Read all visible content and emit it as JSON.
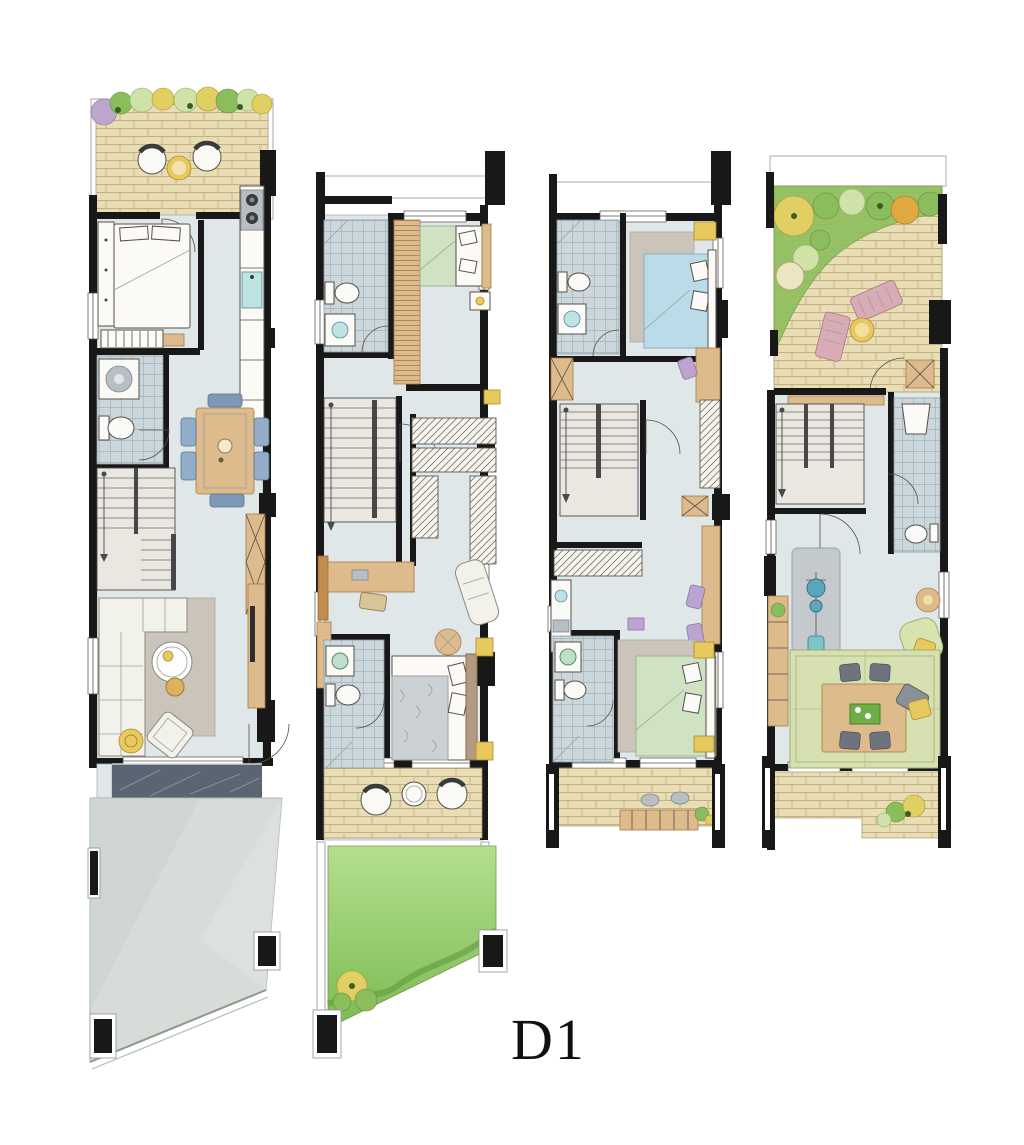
{
  "page": {
    "background": "#ffffff"
  },
  "label": {
    "text": "D1"
  },
  "palette": {
    "wall": "#181818",
    "floor": "#e0e7e8",
    "eave": "#ffffff",
    "brick": "#e9ddb5",
    "brickLine": "#c2b083",
    "tile": "#ccd7dc",
    "tileLine": "#9fb2bc",
    "lawnLight": "#b4df8e",
    "lawnDark": "#7cbb53",
    "wood": "#ddbb8c",
    "woodDark": "#c08d4f",
    "marble": "#5a6573",
    "driveway": "#d7dcd8",
    "yellow": "#e7c95e",
    "teal": "#bfe3e3",
    "pink": "#d9abb4",
    "purple": "#bba4d2",
    "bedGreen": "#cfe2c1",
    "bedBlue": "#badbe7",
    "tatami": "#d6e0b0",
    "labelInk": "#101010"
  },
  "plans": [
    {
      "id": "plan-1",
      "name": "first-floor-plan",
      "rooms": [
        "front-terrace-garden",
        "bedroom",
        "kitchen",
        "bathroom-laundry",
        "stairs",
        "dining-area",
        "living-room",
        "entry-porch",
        "driveway"
      ]
    },
    {
      "id": "plan-2",
      "name": "second-floor-plan",
      "rooms": [
        "bathroom",
        "bedroom",
        "stairs",
        "walk-in-closet",
        "desk-area",
        "master-bedroom",
        "master-bathroom",
        "terrace",
        "lawn-garden"
      ]
    },
    {
      "id": "plan-3",
      "name": "third-floor-plan",
      "rooms": [
        "bathroom",
        "bedroom",
        "stairs",
        "wardrobe",
        "desk-area",
        "bedroom-2",
        "bathroom-2",
        "balcony"
      ]
    },
    {
      "id": "plan-4",
      "name": "fourth-floor-plan",
      "rooms": [
        "roof-garden-terrace",
        "stairs",
        "bathroom",
        "fitness-area",
        "lounge",
        "tatami-room",
        "balcony"
      ]
    }
  ]
}
